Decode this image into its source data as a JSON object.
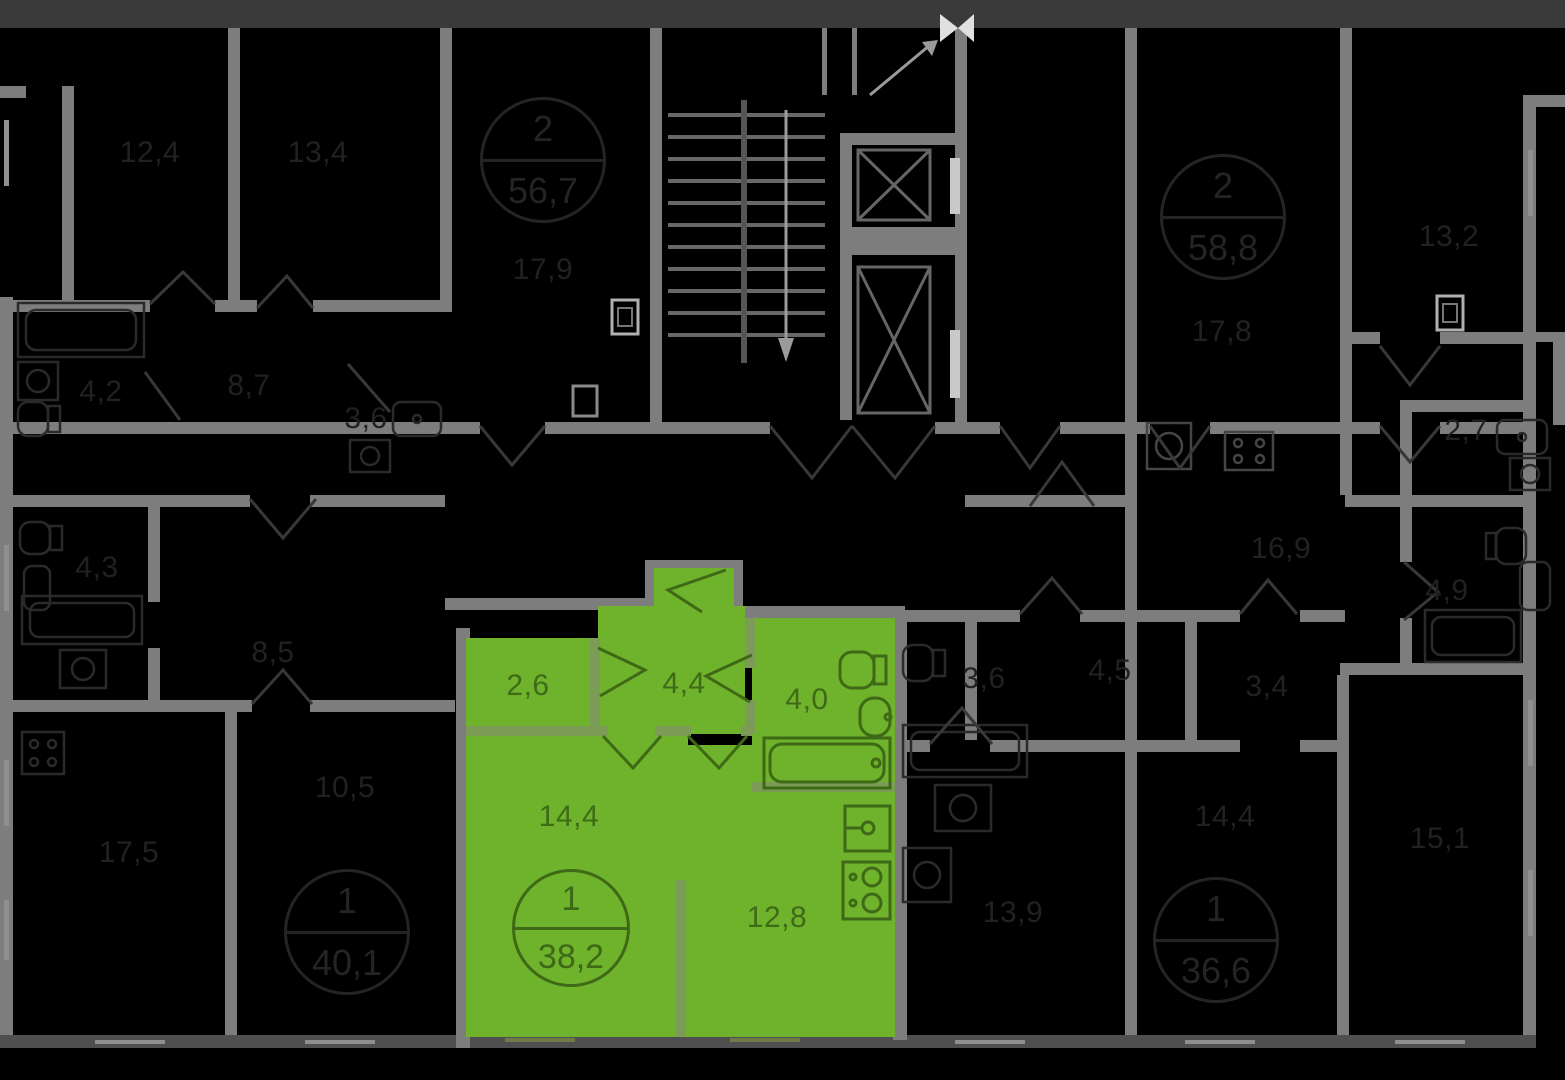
{
  "plan": {
    "background": "#000000",
    "wall_color": "#7d7d7d",
    "highlight_color": "#6fb32c",
    "highlight_text_color": "#3f6a18"
  },
  "highlighted_apartment": {
    "badge": {
      "rooms": "1",
      "area": "38,2"
    },
    "rooms": {
      "wardrobe": "2,6",
      "hall": "4,4",
      "bathroom": "4,0",
      "living": "14,4",
      "kitchen": "12,8"
    }
  },
  "dimmed_apartments": {
    "badges": {
      "top_left": {
        "rooms": "2",
        "area": "56,7"
      },
      "top_right": {
        "rooms": "2",
        "area": "58,8"
      },
      "bottom_left": {
        "rooms": "1",
        "area": "40,1"
      },
      "bottom_right": {
        "rooms": "1",
        "area": "36,6"
      }
    },
    "rooms": {
      "tl_room1": "12,4",
      "tl_room2": "13,4",
      "tl_kitchen": "17,9",
      "tr_kitchen": "17,8",
      "tr_room": "13,2",
      "l_bath": "4,2",
      "l_hall": "8,7",
      "l_wc": "3,6",
      "l_wc2": "4,3",
      "l_hall2": "8,5",
      "bl_room": "17,5",
      "bl_room2": "10,5",
      "c_bath": "3,6",
      "c_hall": "4,5",
      "c_wc": "3,4",
      "c_kitchen": "13,9",
      "br_room": "14,4",
      "br_room2": "15,1",
      "r_hall": "16,9",
      "r_bath": "4,9",
      "r_wc": "2,7"
    }
  }
}
